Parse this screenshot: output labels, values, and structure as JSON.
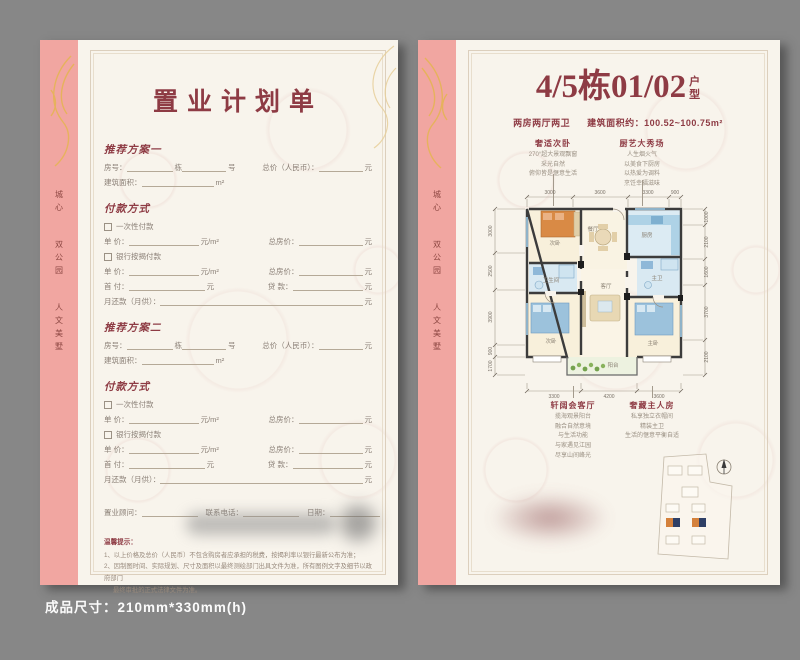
{
  "colors": {
    "accent": "#8e3b44",
    "pink_band": "#f1a6a1",
    "gold": "#e5b455",
    "background": "#878787",
    "bed_orange": "#d98a45",
    "bed_blue": "#9cc2dc",
    "site_orange": "#d4813c",
    "site_navy": "#2e3f66"
  },
  "footer": {
    "caption": "成品尺寸：210mm*330mm(h)"
  },
  "sidebar": {
    "line1": "城心",
    "line2": "双公园",
    "line3": "人文美墅"
  },
  "left_page": {
    "title": "置业计划单",
    "plan1_title": "推荐方案一",
    "plan2_title": "推荐方案二",
    "labels": {
      "room": "房号：",
      "dong": "栋",
      "hao": "号",
      "total": "总价（人民币）：",
      "yuan": "元",
      "area": "建筑面积：",
      "m2": "m²",
      "payment_title": "付款方式",
      "onetime": "一次性付款",
      "unit_price": "单 价：",
      "yuan_per_m2": "元/m²",
      "total_house": "总房价：",
      "mortgage": "银行按揭付款",
      "down": "首 付：",
      "loan": "贷 款：",
      "monthly": "月还款（月供）："
    },
    "footer_row": {
      "consultant": "置业顾问：",
      "phone": "联系电话：",
      "date": "日期："
    },
    "tips_title": "温馨提示：",
    "tip1": "1、以上价格及总价（人民币）不包含购房者应承担的税费，按揭利率以银行最新公布为准；",
    "tip2": "2、因制图时间、实际规划、尺寸及面积以最终测绘部门出具文件为准，所有图例文字及细节以政府部门",
    "tip2b": "最终审批的正式法律文件为准。"
  },
  "right_page": {
    "title_main": "4/5栋01/02",
    "suffix1": "户",
    "suffix2": "型",
    "subtitle_left": "两房两厅两卫",
    "subtitle_right": "建筑面积约：100.52~100.75m²",
    "anno_tl": {
      "title": "奢适次卧",
      "l0": "270°超大景观飘窗",
      "l1": "采光自然",
      "l2": "俯仰皆是惬意生活"
    },
    "anno_tr": {
      "title": "厨艺大秀场",
      "l0": "人生烟火气",
      "l1": "以美食下厨房",
      "l2": "以热爱为调料",
      "l3": "烹饪幸福滋味"
    },
    "anno_bl": {
      "title": "轩阔会客厅",
      "l0": "揽海观景阳台",
      "l1": "融合自然意境",
      "l2": "与生活功能",
      "l3": "与家遇见江园",
      "l4": "尽享山间峰光"
    },
    "anno_br": {
      "title": "奢藏主人房",
      "l0": "私享独立衣帽间",
      "l1": "精装主卫",
      "l2": "生活的惬意平衡自适"
    }
  },
  "floorplan": {
    "dims_top": [
      "3000",
      "3600",
      "3300",
      "900"
    ],
    "dims_left": [
      "3000",
      "2500",
      "3900",
      "900",
      "1700"
    ],
    "dims_right": [
      "1000",
      "2100",
      "1600",
      "3700",
      "2100"
    ],
    "dims_bottom": [
      "3300",
      "4200",
      "3600"
    ],
    "rooms": {
      "bed2": "次卧",
      "dining": "餐厅",
      "kitchen": "厨房",
      "bath2": "卫生间",
      "bed3": "次卧",
      "living": "客厅",
      "master": "主卧",
      "master_bath": "主卫",
      "balcony": "阳台"
    }
  }
}
